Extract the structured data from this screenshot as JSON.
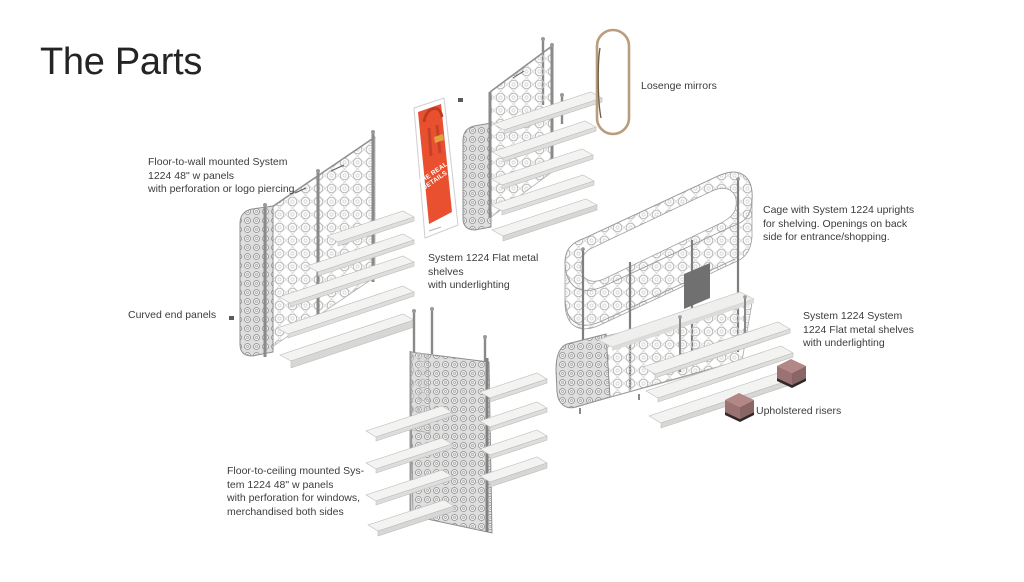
{
  "slide": {
    "title": "The Parts"
  },
  "labels": {
    "floor_to_wall": "Floor-to-wall mounted System\n1224 48\" w panels\nwith perforation or logo piercing",
    "curved_end": "Curved end panels",
    "flat_shelves": "System 1224 Flat metal\nshelves\nwith underlighting",
    "losenge_mirrors": "Losenge mirrors",
    "cage": "Cage with System 1224 uprights\nfor shelving. Openings on back\nside for entrance/shopping.",
    "system_1224_shelves": "System 1224 System\n1224 Flat metal shelves\nwith underlighting",
    "upholstered_risers": "Upholstered risers",
    "floor_to_ceiling": "Floor-to-ceiling mounted Sys-\ntem 1224 48\" w panels\nwith perforation for windows,\nmerchandised both sides"
  },
  "poster": {
    "text": "THE REAL\nDETAILS"
  },
  "colors": {
    "background": "#ffffff",
    "text": "#3c3c3b",
    "title": "#262324",
    "panel_pattern_light": "#b9b9b9",
    "panel_pattern_dense": "#8e8e8e",
    "shelf_white": "#f2f2f0",
    "metal_gray": "#8d8d8d",
    "mirror_frame": "#b99d7c",
    "poster_red": "#e8502f",
    "riser_mauve": "#b48787"
  }
}
